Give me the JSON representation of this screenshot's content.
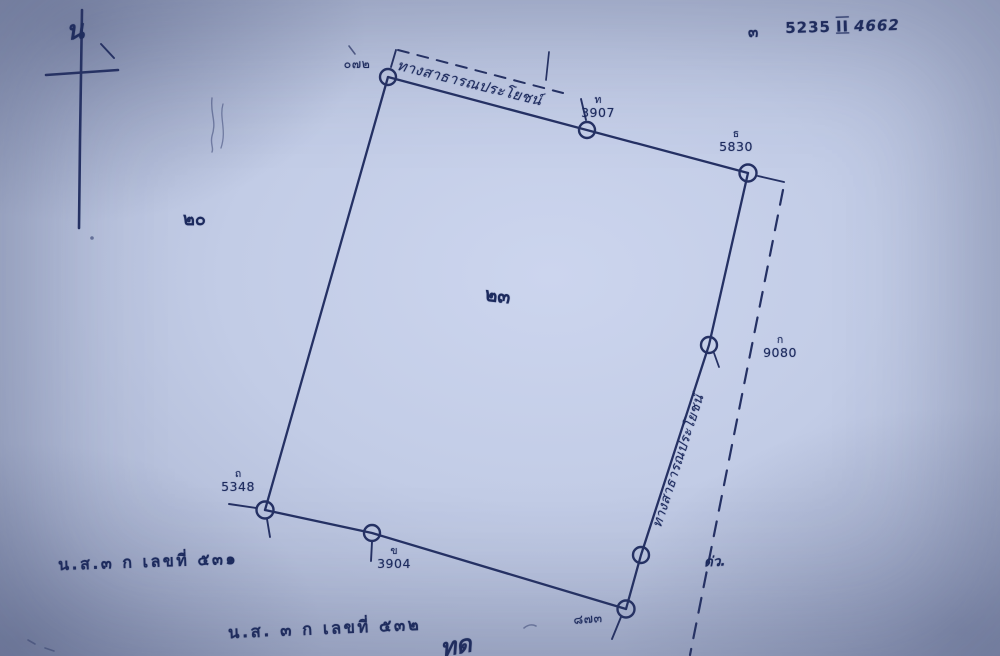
{
  "document": {
    "kind": "scanned land survey sketch",
    "colors": {
      "paper": "#c2cce6",
      "ink": "#253164"
    }
  },
  "north": {
    "label": "น"
  },
  "map_sheet": {
    "prefix": "๓",
    "number": "5235",
    "roman": "II",
    "suffix": "4662"
  },
  "roads": {
    "top_label": "ทางสาธารณประโยชน์",
    "right_label": "ทางสาธารณประโยชน์"
  },
  "parcel": {
    "center_number": "๒๓",
    "left_number": "๒๐"
  },
  "points": {
    "top": {
      "number": "๐๗๒"
    },
    "north_mid": {
      "letter": "ท",
      "number": "3907"
    },
    "northeast": {
      "letter": "ธ",
      "number": "5830"
    },
    "east": {
      "letter": "ก",
      "number": "9080"
    },
    "southeast": {
      "number": "๘๗๓"
    },
    "south_mid": {
      "letter": "ข",
      "number": "3904"
    },
    "southwest": {
      "letter": "ถ",
      "number": "5348"
    }
  },
  "annotations": {
    "near_dashed": "ด่ว.",
    "bottom_partial": "ทด"
  },
  "notes": {
    "bottom_left": "น.ส.๓ ก เลขที่ ๕๓๑",
    "bottom_center": "น.ส. ๓ ก เลขที่ ๕๓๒"
  }
}
